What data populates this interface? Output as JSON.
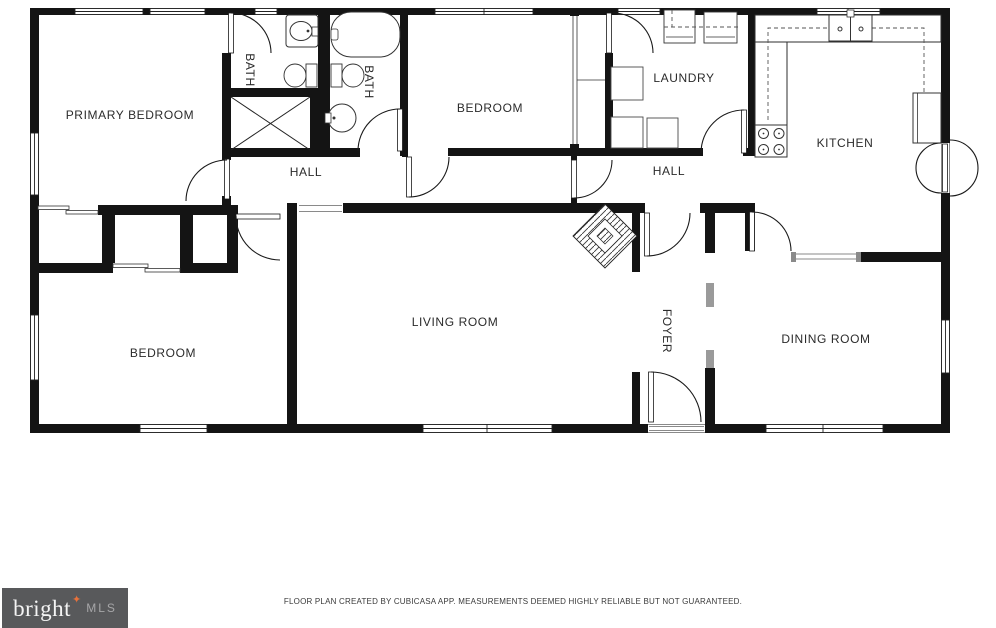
{
  "rooms": [
    {
      "id": "primary-bedroom",
      "label": "PRIMARY BEDROOM"
    },
    {
      "id": "bath-1",
      "label": "BATH"
    },
    {
      "id": "bath-2",
      "label": "BATH"
    },
    {
      "id": "bedroom-top",
      "label": "BEDROOM"
    },
    {
      "id": "laundry",
      "label": "LAUNDRY"
    },
    {
      "id": "kitchen",
      "label": "KITCHEN"
    },
    {
      "id": "hall-left",
      "label": "HALL"
    },
    {
      "id": "hall-right",
      "label": "HALL"
    },
    {
      "id": "bedroom-bottom",
      "label": "BEDROOM"
    },
    {
      "id": "living-room",
      "label": "LIVING ROOM"
    },
    {
      "id": "foyer",
      "label": "FOYER"
    },
    {
      "id": "dining-room",
      "label": "DINING ROOM"
    }
  ],
  "footer": {
    "disclaimer": "FLOOR PLAN CREATED BY CUBICASA APP. MEASUREMENTS DEEMED HIGHLY RELIABLE BUT NOT GUARANTEED.",
    "logo": {
      "brand": "bright",
      "star": "✦",
      "suffix": "MLS"
    }
  },
  "colors": {
    "wall": "#141414",
    "label": "#2b2b2b",
    "logo_background": "#58595b",
    "logo_star": "#e8713b",
    "logo_suffix": "#a6a6a8"
  }
}
